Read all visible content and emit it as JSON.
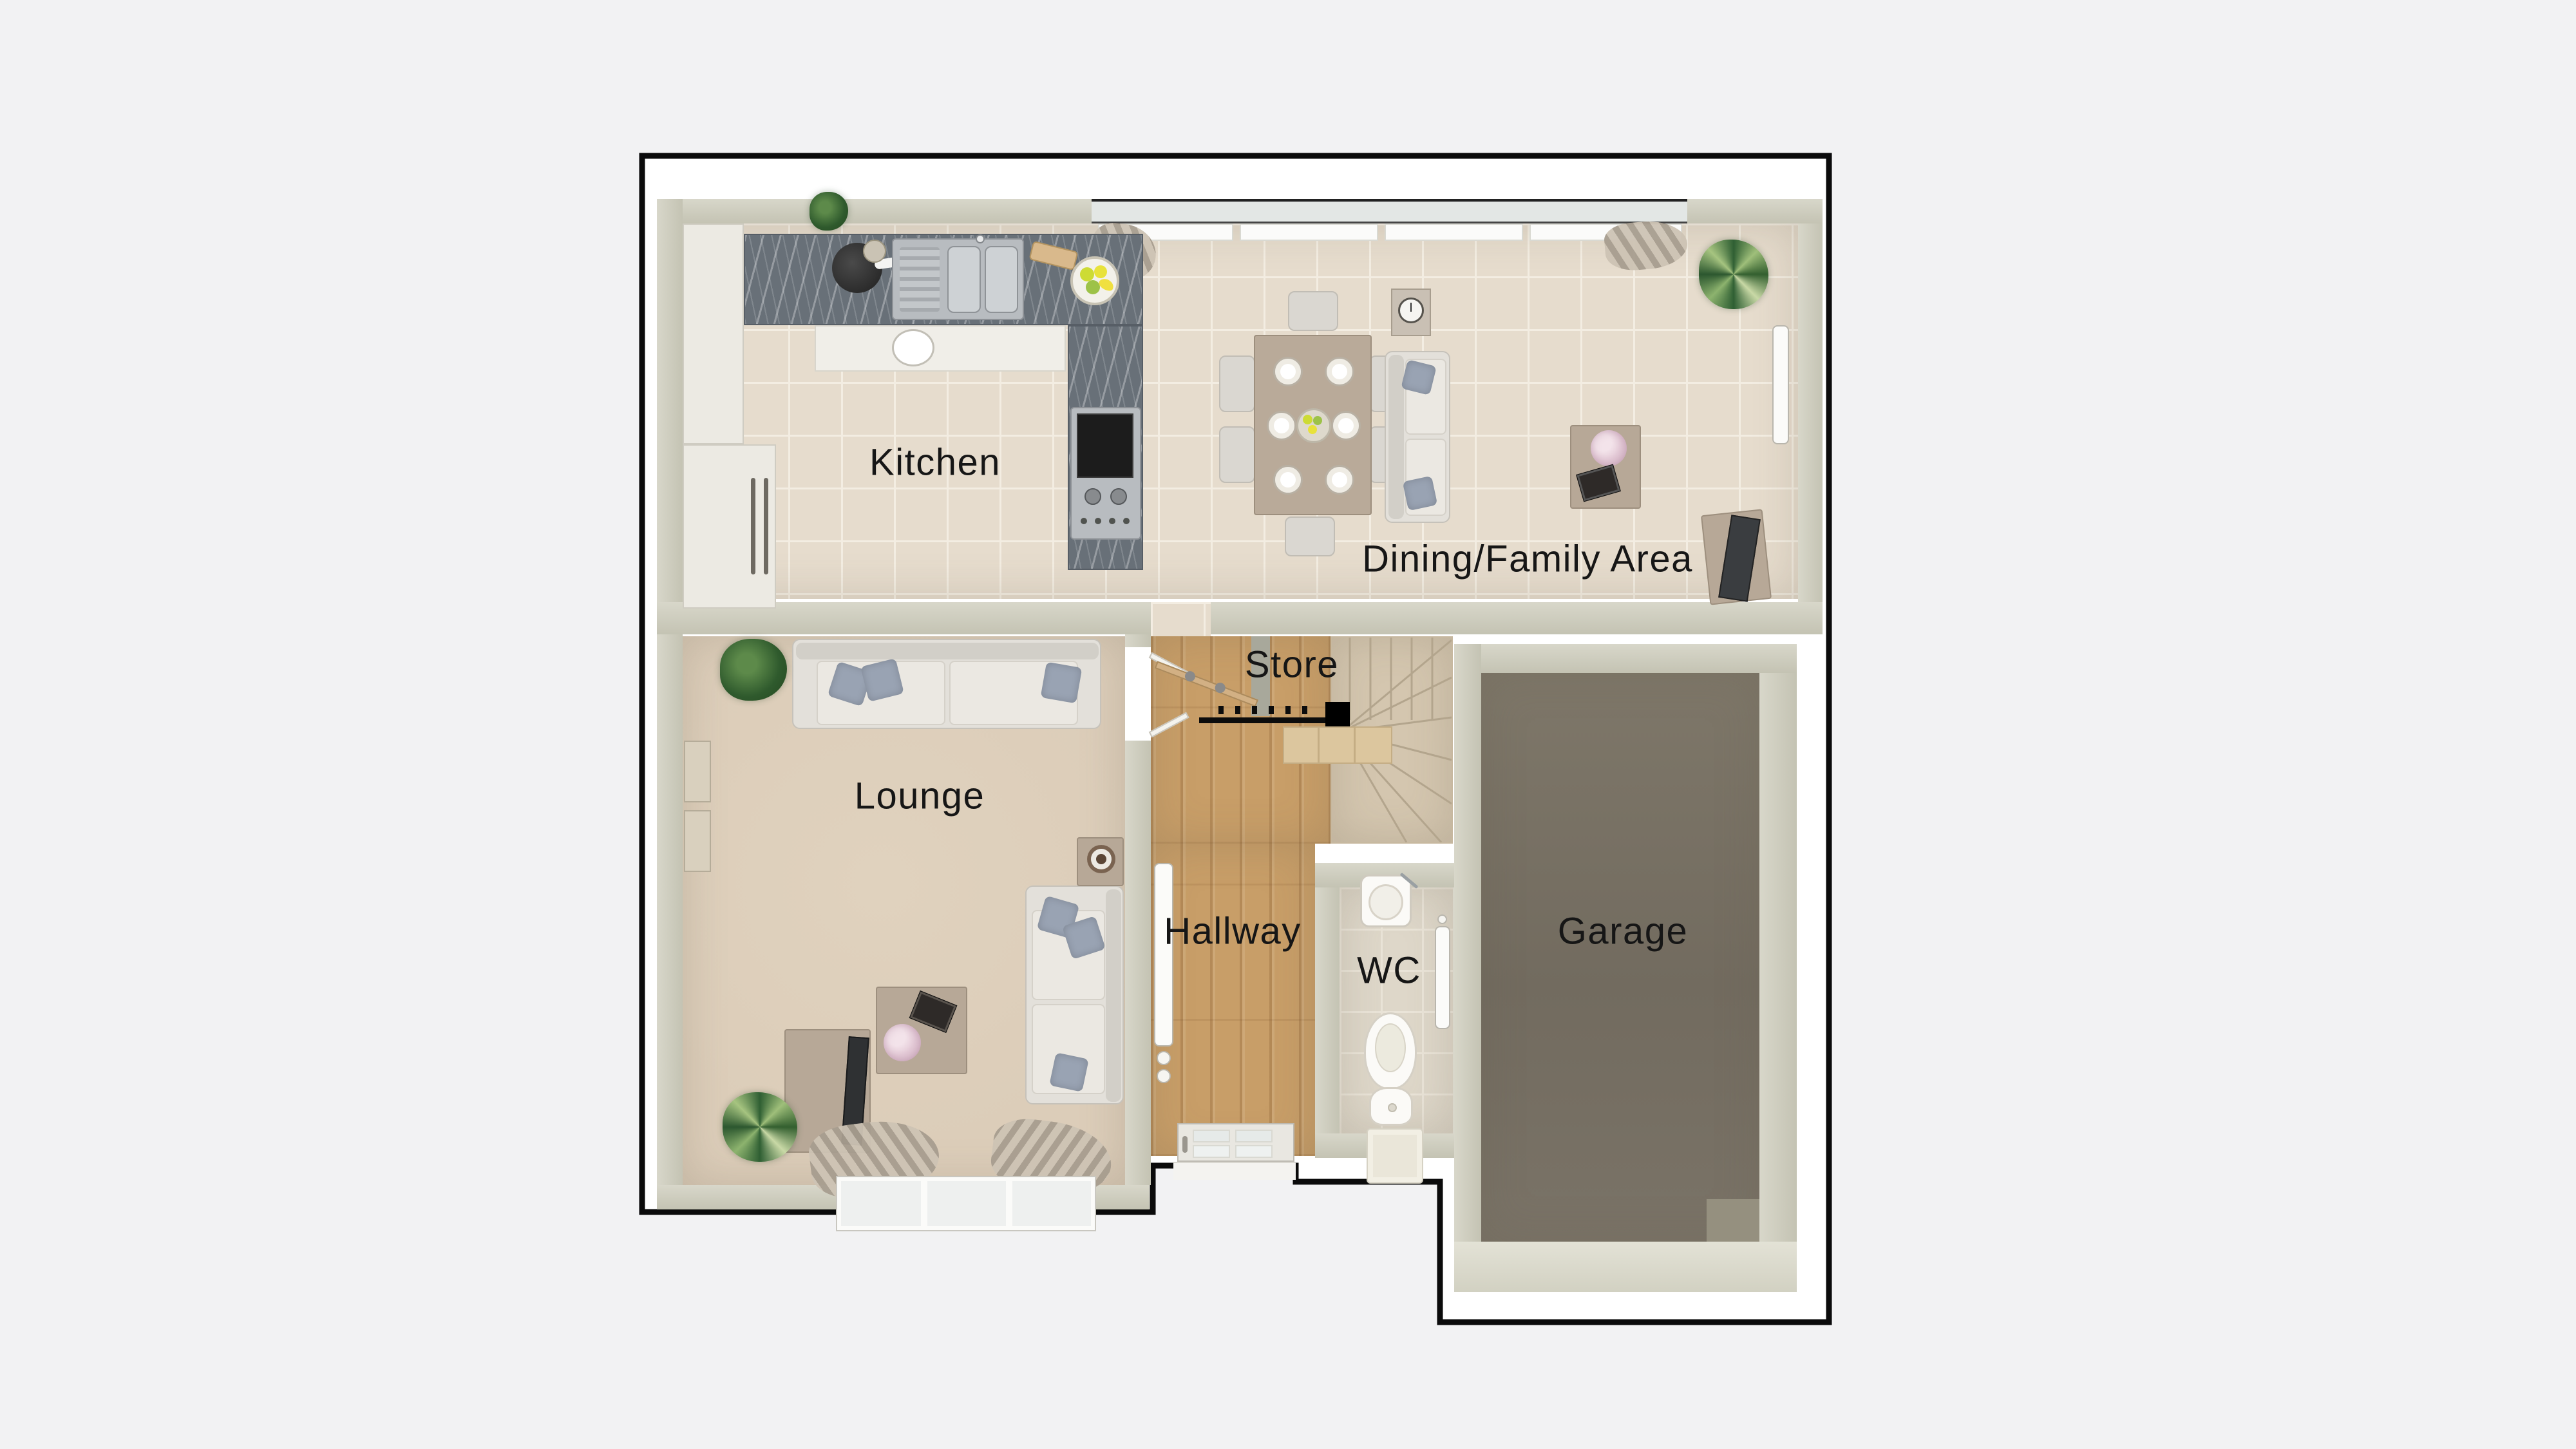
{
  "floorplan": {
    "rooms": {
      "kitchen": {
        "label": "Kitchen"
      },
      "dining": {
        "label": "Dining/Family Area"
      },
      "lounge": {
        "label": "Lounge"
      },
      "store": {
        "label": "Store"
      },
      "hallway": {
        "label": "Hallway"
      },
      "wc": {
        "label": "WC"
      },
      "garage": {
        "label": "Garage"
      }
    },
    "colors": {
      "pageBg": "#f2f2f3",
      "outline": "#0b0b0b",
      "wallLight": "#d8d7ca",
      "wallDark": "#c4c3b3",
      "tile": "#e6dccd",
      "grout": "#f3ede2",
      "carpet": "#dccdb9",
      "wood": "#c89e68",
      "stairCarpet": "#d4c6af",
      "garageFloor": "#7a7367",
      "wcFloor": "#ded7c9",
      "marble": "#687078",
      "cabinet": "#eceae3",
      "labelColor": "#161616"
    }
  }
}
